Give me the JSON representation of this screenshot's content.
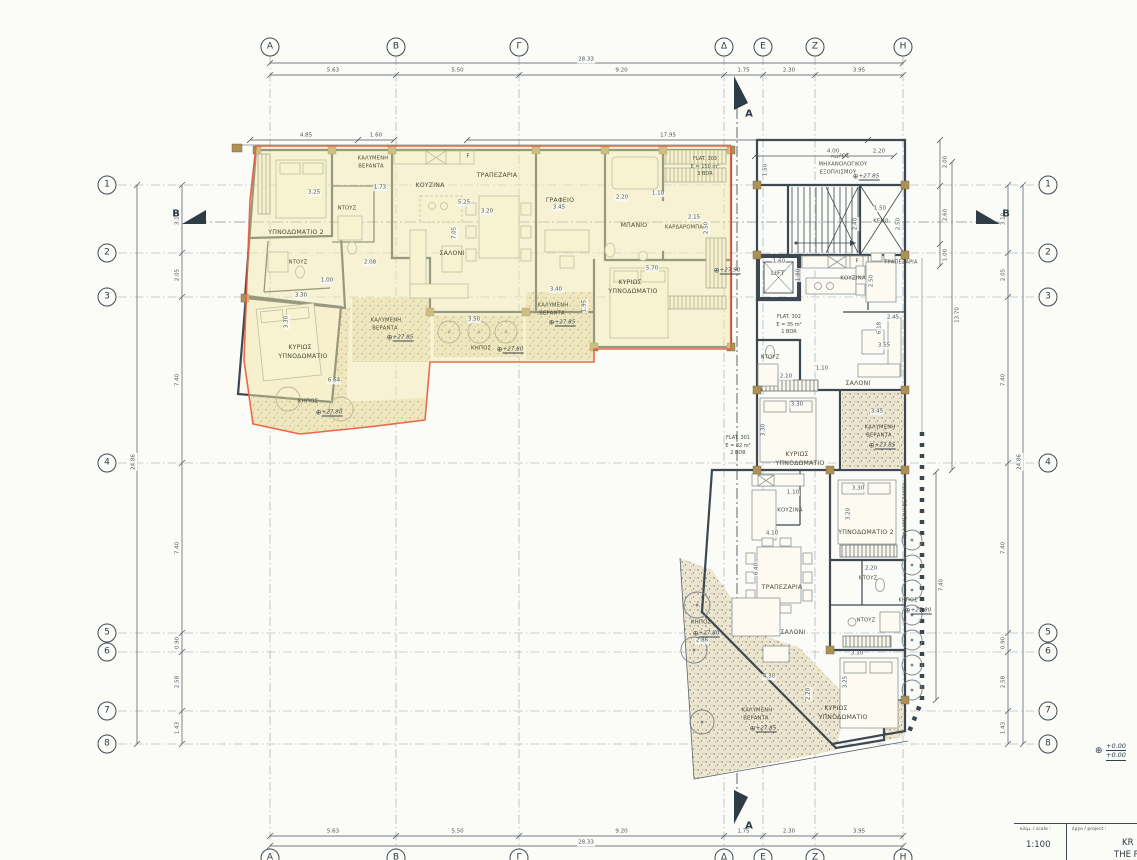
{
  "grid": {
    "columns": {
      "labels": [
        "A",
        "B",
        "Γ",
        "Δ",
        "E",
        "Z",
        "H"
      ],
      "x": [
        270,
        396,
        519,
        724,
        763,
        815,
        903
      ],
      "segments": [
        "5.63",
        "5.50",
        "9.20",
        "1.75",
        "2.30",
        "3.95"
      ],
      "overall": "28.33"
    },
    "rows": {
      "labels": [
        "1",
        "2",
        "3",
        "4",
        "5",
        "6",
        "7",
        "8"
      ],
      "y": [
        185,
        253,
        297,
        463,
        633,
        652,
        711,
        744
      ],
      "segments": [
        "3.10",
        "2.05",
        "7.40",
        "7.40",
        "0.90",
        "2.58",
        "1.43"
      ],
      "overall": "24.86"
    }
  },
  "flats": [
    {
      "id": "FLAT. 303",
      "area": "E = 150 m²",
      "bdr": "3 BDR",
      "x": 705,
      "y": 167
    },
    {
      "id": "FLAT. 302",
      "area": "E = 35 m²",
      "bdr": "1 BDR",
      "x": 789,
      "y": 325
    },
    {
      "id": "FLAT. 301",
      "area": "E = 82 m²",
      "bdr": "2 BDR",
      "x": 738,
      "y": 446
    }
  ],
  "room_labels": [
    {
      "t": "ΥΠΝΟΔΩΜΑΤΙΟ 2",
      "x": 296,
      "y": 233
    },
    {
      "t": "ΚΑΛΥΜΕΝΗ",
      "x": 373,
      "y": 159,
      "fs": 5.2
    },
    {
      "t": "ΒΕΡΑΝΤΑ",
      "x": 371,
      "y": 167,
      "fs": 5.2
    },
    {
      "t": "ΚΟΥΖΙΝΑ",
      "x": 430,
      "y": 186
    },
    {
      "t": "ΤΡΑΠΕΖΑΡΙΑ",
      "x": 497,
      "y": 176
    },
    {
      "t": "ΓΡΑΦΕΙΟ",
      "x": 560,
      "y": 201
    },
    {
      "t": "ΜΠΑΝΙΟ",
      "x": 634,
      "y": 226
    },
    {
      "t": "ΚΑΡΔΑΡΟΜΠΑ",
      "x": 684,
      "y": 228,
      "fs": 5.2
    },
    {
      "t": "ΝΤΟΥΖ",
      "x": 347,
      "y": 209,
      "fs": 5.2
    },
    {
      "t": "ΣΑΛΟΝΙ",
      "x": 452,
      "y": 254
    },
    {
      "t": "ΝΤΟΥΖ",
      "x": 298,
      "y": 263,
      "fs": 5.2
    },
    {
      "t": "ΚΥΡΙΩΣ",
      "x": 300,
      "y": 348
    },
    {
      "t": "ΥΠΝΟΔΩΜΑΤΙΟ",
      "x": 303,
      "y": 357
    },
    {
      "t": "ΚΑΛΥΜΕΝΗ",
      "x": 386,
      "y": 321,
      "fs": 5.2
    },
    {
      "t": "ΒΕΡΑΝΤΑ",
      "x": 385,
      "y": 329,
      "fs": 5.2
    },
    {
      "t": "ΚΗΠΟΣ",
      "x": 308,
      "y": 402,
      "fs": 5.4
    },
    {
      "t": "ΚΑΛΥΜΕΝΗ",
      "x": 553,
      "y": 306,
      "fs": 5.2
    },
    {
      "t": "ΒΕΡΑΝΤΑ",
      "x": 552,
      "y": 314,
      "fs": 5.2
    },
    {
      "t": "ΚΗΠΟΣ",
      "x": 481,
      "y": 349,
      "fs": 5.4
    },
    {
      "t": "ΚΥΡΙΩΣ",
      "x": 630,
      "y": 283
    },
    {
      "t": "ΥΠΝΟΔΩΜΑΤΙΟ",
      "x": 633,
      "y": 292
    },
    {
      "t": "ΧΩΡΟΣ",
      "x": 840,
      "y": 157,
      "fs": 5.2
    },
    {
      "t": "ΜΗΧΑΝΟΛΟΓΙΚΟΥ",
      "x": 843,
      "y": 165,
      "fs": 5.2
    },
    {
      "t": "ΕΞΟΠΛΙΣΜΟΥ",
      "x": 838,
      "y": 173,
      "fs": 5.2
    },
    {
      "t": "ΚΕΝΟ",
      "x": 881,
      "y": 222,
      "fs": 5.2
    },
    {
      "t": "LIFT",
      "x": 778,
      "y": 273,
      "fs": 6.5
    },
    {
      "t": "ΚΟΥΖΙΝΑ",
      "x": 853,
      "y": 279,
      "fs": 5.4
    },
    {
      "t": "ΤΡΑΠΕΖΑΡΙΑ",
      "x": 901,
      "y": 263,
      "fs": 5
    },
    {
      "t": "ΝΤΟΥΖ",
      "x": 770,
      "y": 358,
      "fs": 5.2
    },
    {
      "t": "ΣΑΛΟΝΙ",
      "x": 858,
      "y": 384
    },
    {
      "t": "ΚΥΡΙΩΣ",
      "x": 797,
      "y": 455
    },
    {
      "t": "ΥΠΝΟΔΩΜΑΤΙΟ",
      "x": 800,
      "y": 464
    },
    {
      "t": "ΚΑΛΥΜΕΝΗ",
      "x": 880,
      "y": 428,
      "fs": 5.2
    },
    {
      "t": "ΒΕΡΑΝΤΑ",
      "x": 879,
      "y": 436,
      "fs": 5.2
    },
    {
      "t": "ΚΟΥΖΙΝΑ",
      "x": 790,
      "y": 511,
      "fs": 5.4
    },
    {
      "t": "ΥΠΝΟΔΩΜΑΤΙΟ 2",
      "x": 866,
      "y": 533
    },
    {
      "t": "ΤΡΑΠΕΖΑΡΙΑ",
      "x": 782,
      "y": 588
    },
    {
      "t": "ΝΤΟΥΖ",
      "x": 868,
      "y": 579,
      "fs": 5.2
    },
    {
      "t": "ΝΤΟΥΖ",
      "x": 866,
      "y": 621,
      "fs": 5.2
    },
    {
      "t": "ΚΑΛΥΜΕΝΗ ΒΕΡΑΝΤΑ",
      "x": 906,
      "y": 510,
      "r": 1,
      "fs": 5
    },
    {
      "t": "ΣΑΛΟΝΙ",
      "x": 793,
      "y": 633
    },
    {
      "t": "ΚΗΠΟΣ",
      "x": 701,
      "y": 623,
      "fs": 5.4
    },
    {
      "t": "ΚΗΠΟΣ",
      "x": 908,
      "y": 601,
      "fs": 5
    },
    {
      "t": "ΚΥΡΙΩΣ",
      "x": 836,
      "y": 709
    },
    {
      "t": "ΥΠΝΟΔΩΜΑΤΙΟ",
      "x": 843,
      "y": 718
    },
    {
      "t": "ΚΑΛΥΜΕΝΗ",
      "x": 757,
      "y": 711,
      "fs": 5.2
    },
    {
      "t": "ΒΕΡΑΝΤΑ",
      "x": 756,
      "y": 719,
      "fs": 5.2
    },
    {
      "t": "F",
      "x": 468,
      "y": 157,
      "fs": 5
    },
    {
      "t": "F",
      "x": 857,
      "y": 262,
      "fs": 5
    }
  ],
  "dim_labels": [
    {
      "t": "4.85",
      "x": 306,
      "y": 136
    },
    {
      "t": "1.60",
      "x": 376,
      "y": 136
    },
    {
      "t": "17.95",
      "x": 668,
      "y": 136
    },
    {
      "t": "4.00",
      "x": 833,
      "y": 152
    },
    {
      "t": "2.20",
      "x": 879,
      "y": 152
    },
    {
      "t": "2.00",
      "x": 946,
      "y": 162,
      "r": 1
    },
    {
      "t": "2.60",
      "x": 946,
      "y": 215,
      "r": 1
    },
    {
      "t": "1.00",
      "x": 946,
      "y": 255,
      "r": 1
    },
    {
      "t": "13.70",
      "x": 958,
      "y": 315,
      "r": 1
    },
    {
      "t": "7.40",
      "x": 942,
      "y": 585,
      "r": 1
    },
    {
      "t": "3.25",
      "x": 314,
      "y": 193
    },
    {
      "t": "1.73",
      "x": 380,
      "y": 188
    },
    {
      "t": "5.25",
      "x": 464,
      "y": 203
    },
    {
      "t": "3.20",
      "x": 487,
      "y": 212
    },
    {
      "t": "7.05",
      "x": 455,
      "y": 233,
      "r": 1
    },
    {
      "t": "3.45",
      "x": 559,
      "y": 208
    },
    {
      "t": "2.20",
      "x": 622,
      "y": 198
    },
    {
      "t": "1.10",
      "x": 658,
      "y": 194
    },
    {
      "t": "2.15",
      "x": 694,
      "y": 218
    },
    {
      "t": "2.50",
      "x": 707,
      "y": 228,
      "r": 1
    },
    {
      "t": "5.70",
      "x": 652,
      "y": 269
    },
    {
      "t": "2.08",
      "x": 370,
      "y": 263
    },
    {
      "t": "1.00",
      "x": 327,
      "y": 281
    },
    {
      "t": "3.30",
      "x": 301,
      "y": 296
    },
    {
      "t": "3.30",
      "x": 287,
      "y": 322,
      "r": 1
    },
    {
      "t": "6.64",
      "x": 334,
      "y": 381
    },
    {
      "t": "3.50",
      "x": 474,
      "y": 320
    },
    {
      "t": "3.40",
      "x": 556,
      "y": 290
    },
    {
      "t": "1.95",
      "x": 585,
      "y": 306,
      "r": 1
    },
    {
      "t": "1.50",
      "x": 766,
      "y": 170,
      "r": 1
    },
    {
      "t": "1.50",
      "x": 880,
      "y": 209
    },
    {
      "t": "2.40",
      "x": 856,
      "y": 224,
      "r": 1
    },
    {
      "t": "2.50",
      "x": 899,
      "y": 224,
      "r": 1
    },
    {
      "t": "1.60",
      "x": 779,
      "y": 262
    },
    {
      "t": "1.80",
      "x": 799,
      "y": 275,
      "r": 1
    },
    {
      "t": "2.50",
      "x": 872,
      "y": 281,
      "r": 1
    },
    {
      "t": "2.45",
      "x": 893,
      "y": 318
    },
    {
      "t": "6.18",
      "x": 880,
      "y": 328,
      "r": 1
    },
    {
      "t": "1.10",
      "x": 822,
      "y": 369
    },
    {
      "t": "3.55",
      "x": 884,
      "y": 346
    },
    {
      "t": "2.10",
      "x": 786,
      "y": 377
    },
    {
      "t": "3.30",
      "x": 797,
      "y": 405
    },
    {
      "t": "3.30",
      "x": 764,
      "y": 430,
      "r": 1
    },
    {
      "t": "3.45",
      "x": 877,
      "y": 412
    },
    {
      "t": "1.10",
      "x": 793,
      "y": 493
    },
    {
      "t": "3.30",
      "x": 858,
      "y": 489
    },
    {
      "t": "3.20",
      "x": 849,
      "y": 514,
      "r": 1
    },
    {
      "t": "4.10",
      "x": 772,
      "y": 534
    },
    {
      "t": "6.40",
      "x": 757,
      "y": 569,
      "r": 1
    },
    {
      "t": "2.20",
      "x": 871,
      "y": 569
    },
    {
      "t": "3.30",
      "x": 857,
      "y": 654
    },
    {
      "t": "3.25",
      "x": 846,
      "y": 682,
      "r": 1
    },
    {
      "t": "4.30",
      "x": 769,
      "y": 677
    },
    {
      "t": "2.86",
      "x": 702,
      "y": 641
    },
    {
      "t": "2.20",
      "x": 809,
      "y": 694,
      "r": 1
    }
  ],
  "level_markers": [
    {
      "v": "+27.85",
      "x": 866,
      "y": 177
    },
    {
      "v": "+27.90",
      "x": 727,
      "y": 271
    },
    {
      "v": "+27.85",
      "x": 400,
      "y": 338
    },
    {
      "v": "+27.80",
      "x": 329,
      "y": 413
    },
    {
      "v": "+27.80",
      "x": 510,
      "y": 350
    },
    {
      "v": "+27.85",
      "x": 562,
      "y": 323
    },
    {
      "v": "+27.85",
      "x": 882,
      "y": 446
    },
    {
      "v": "+27.80",
      "x": 706,
      "y": 634
    },
    {
      "v": "+27.80",
      "x": 918,
      "y": 611
    },
    {
      "v": "+27.85",
      "x": 763,
      "y": 729
    }
  ],
  "section_markers": [
    {
      "label": "A",
      "x": 749,
      "y": 114
    },
    {
      "label": "A",
      "x": 749,
      "y": 826
    },
    {
      "label": "B",
      "x": 176,
      "y": 214
    },
    {
      "label": "B",
      "x": 1006,
      "y": 214
    }
  ],
  "planters": [
    {
      "x": 288,
      "y": 399,
      "r": 12
    },
    {
      "x": 341,
      "y": 409,
      "r": 12
    },
    {
      "x": 449,
      "y": 332,
      "r": 11
    },
    {
      "x": 479,
      "y": 332,
      "r": 11
    },
    {
      "x": 506,
      "y": 332,
      "r": 11
    },
    {
      "x": 697,
      "y": 605,
      "r": 13
    },
    {
      "x": 694,
      "y": 650,
      "r": 13
    },
    {
      "x": 702,
      "y": 722,
      "r": 12
    },
    {
      "x": 912,
      "y": 540,
      "r": 10
    },
    {
      "x": 912,
      "y": 565,
      "r": 10
    },
    {
      "x": 912,
      "y": 590,
      "r": 10
    },
    {
      "x": 912,
      "y": 615,
      "r": 10
    },
    {
      "x": 912,
      "y": 640,
      "r": 10
    },
    {
      "x": 912,
      "y": 665,
      "r": 10
    },
    {
      "x": 912,
      "y": 690,
      "r": 10
    }
  ],
  "datum": {
    "line1": "+0.00",
    "line2": "+0.00"
  },
  "title_block": {
    "scale_label": "κλίμ. / scale :",
    "scale_value": "1:100",
    "project_label": "έργο / project :",
    "project_name_line1": "KR",
    "project_name_line2": "THE PL"
  },
  "colors": {
    "highlight": "#f1e9ad",
    "boundary": "#ea5a3a",
    "ink": "#3d4850",
    "hatch_bg": "#ece5cf",
    "hatch_dot": "#6e685a"
  }
}
